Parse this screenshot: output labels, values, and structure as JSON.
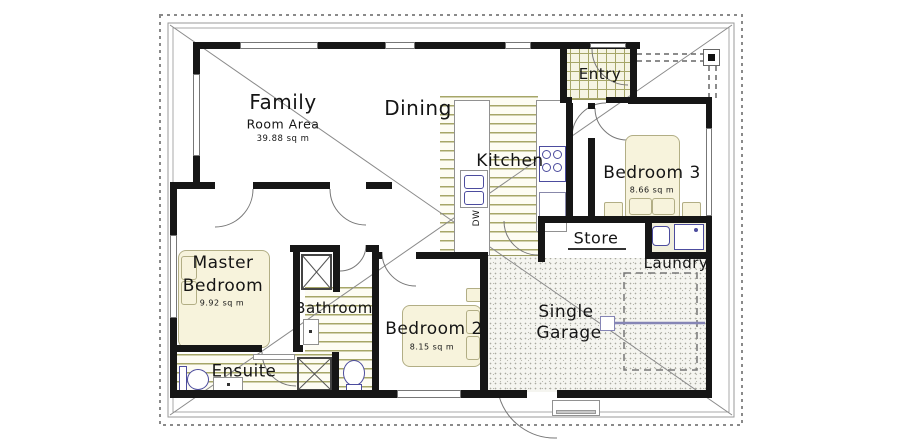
{
  "plan_title": "single-storey house floor plan",
  "rooms": {
    "family": {
      "label": "Family",
      "sublabel": "Room Area",
      "area": "39.88 sq m"
    },
    "dining": {
      "label": "Dining"
    },
    "kitchen": {
      "label": "Kitchen"
    },
    "entry": {
      "label": "Entry"
    },
    "bedroom3": {
      "label": "Bedroom 3",
      "area": "8.66 sq m"
    },
    "store": {
      "label": "Store"
    },
    "laundry": {
      "label": "Laundry"
    },
    "master": {
      "label_line1": "Master",
      "label_line2": "Bedroom",
      "area": "9.92 sq m"
    },
    "bathroom": {
      "label": "Bathroom"
    },
    "bedroom2": {
      "label": "Bedroom 2",
      "area": "8.15 sq m"
    },
    "ensuite": {
      "label": "Ensuite"
    },
    "garage": {
      "label_line1": "Single",
      "label_line2": "Garage"
    }
  },
  "appliances": {
    "dishwasher": "DW"
  },
  "colors": {
    "wall": "#161616",
    "floor_line_olive": "#a6a668",
    "furniture_cream": "#f7f3dc",
    "fixture_outline_purple": "#4c4c9e",
    "roof_line_gray": "#8a8a8a"
  }
}
